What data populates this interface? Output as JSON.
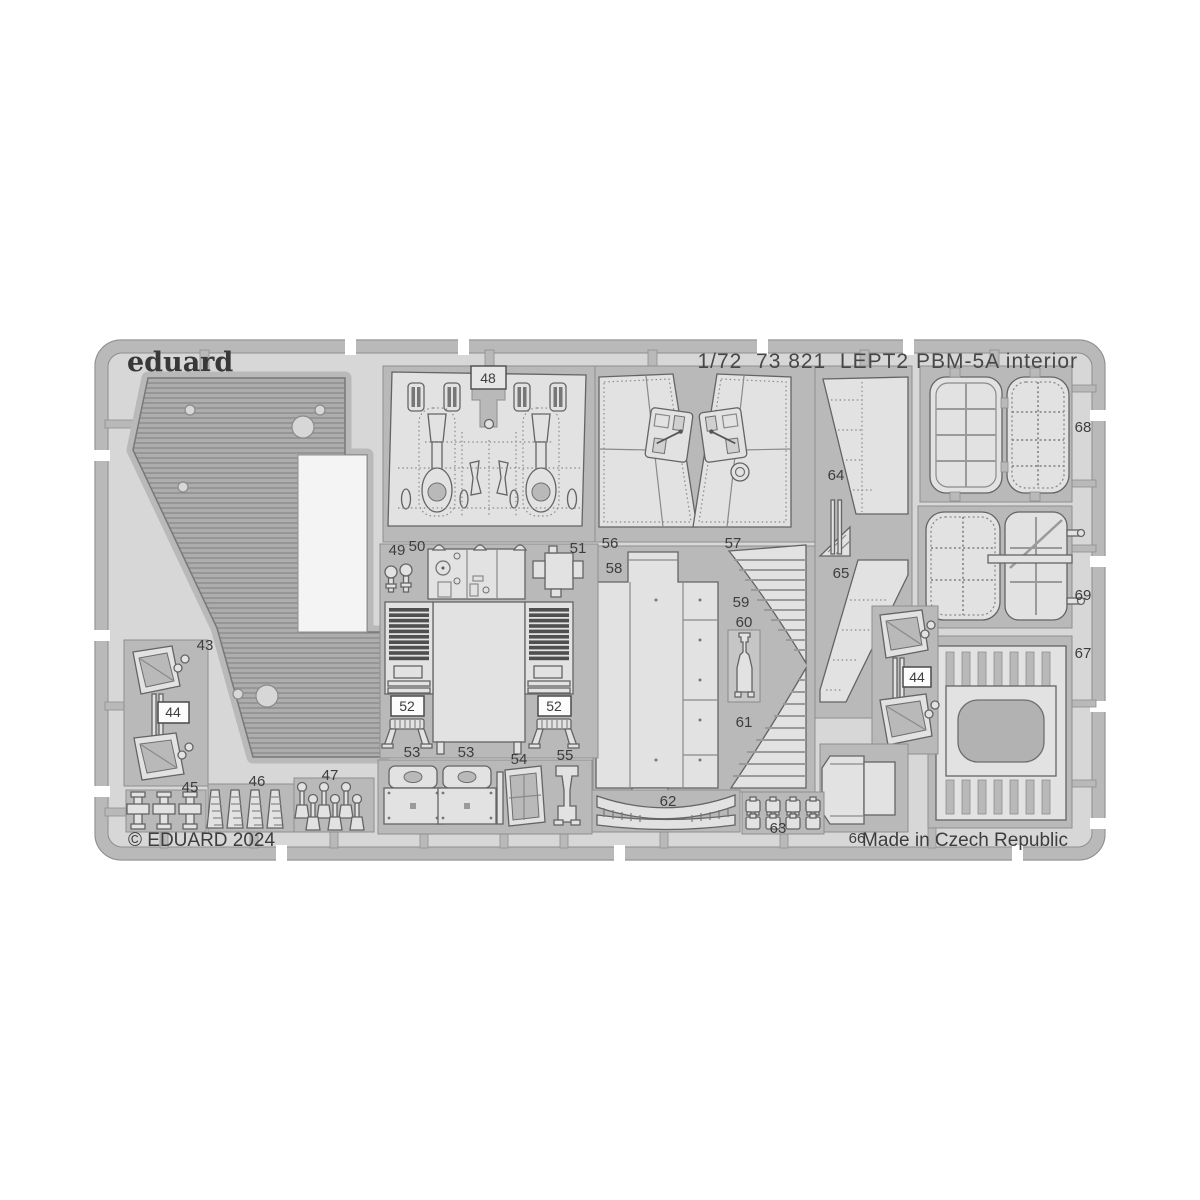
{
  "header": {
    "logo_text": "eduard",
    "title": "1/72  73 821  LEPT2 PBM-5A interior",
    "scale": "1/72",
    "catalog_number": "73 821",
    "sheet_code": "LEPT2",
    "subject": "PBM-5A interior"
  },
  "footer": {
    "copyright": "© EDUARD 2024",
    "origin": "Made in Czech Republic"
  },
  "colors": {
    "page_bg": "#ffffff",
    "sheet_bg": "#d7d7d7",
    "frame_plate": "#b9b9b9",
    "part_fill": "#e2e2e2",
    "part_outline": "#646464",
    "corrugation_fill": "#adadad",
    "louver_dark": "#4f4f4f",
    "text": "#3d3d3d"
  },
  "part_labels": [
    {
      "text": "43",
      "boxed": false
    },
    {
      "text": "44",
      "boxed": true
    },
    {
      "text": "45",
      "boxed": false
    },
    {
      "text": "46",
      "boxed": false
    },
    {
      "text": "47",
      "boxed": false
    },
    {
      "text": "48",
      "boxed": true
    },
    {
      "text": "49",
      "boxed": false
    },
    {
      "text": "50",
      "boxed": false
    },
    {
      "text": "51",
      "boxed": false
    },
    {
      "text": "52",
      "boxed": true
    },
    {
      "text": "52",
      "boxed": true
    },
    {
      "text": "53",
      "boxed": false
    },
    {
      "text": "53",
      "boxed": false
    },
    {
      "text": "54",
      "boxed": false
    },
    {
      "text": "55",
      "boxed": false
    },
    {
      "text": "56",
      "boxed": false
    },
    {
      "text": "57",
      "boxed": false
    },
    {
      "text": "58",
      "boxed": false
    },
    {
      "text": "59",
      "boxed": false
    },
    {
      "text": "60",
      "boxed": false
    },
    {
      "text": "61",
      "boxed": false
    },
    {
      "text": "62",
      "boxed": false
    },
    {
      "text": "63",
      "boxed": false
    },
    {
      "text": "64",
      "boxed": false
    },
    {
      "text": "65",
      "boxed": false
    },
    {
      "text": "66",
      "boxed": false
    },
    {
      "text": "67",
      "boxed": false
    },
    {
      "text": "68",
      "boxed": false
    },
    {
      "text": "69",
      "boxed": false
    },
    {
      "text": "44",
      "boxed": true
    }
  ]
}
